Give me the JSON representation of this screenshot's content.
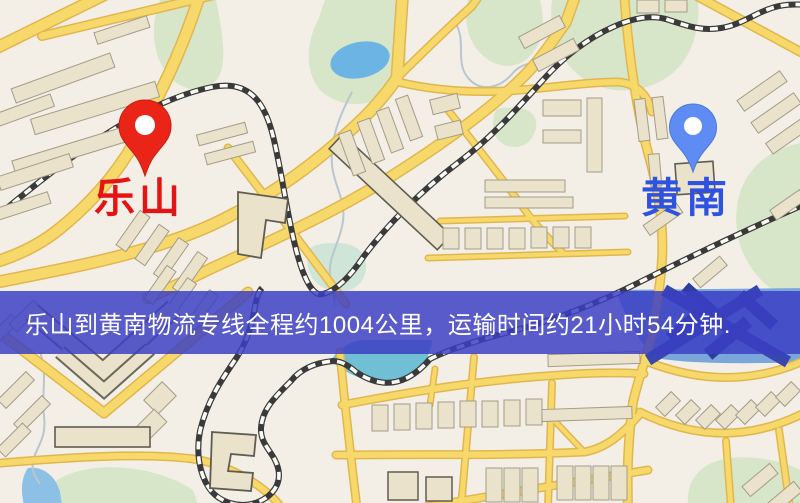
{
  "map": {
    "markers": {
      "origin": {
        "name": "乐山",
        "pin_color": "#ea2417",
        "label_color": "#e51313"
      },
      "destination": {
        "name": "黄南",
        "pin_color": "#5e8cf2",
        "label_color": "#2f52e0"
      }
    },
    "banner": {
      "text": "乐山到黄南物流专线全程约1004公里，运输时间约21小时54分钟.",
      "background": "#3a3ec4",
      "text_color": "#ffffff"
    },
    "palette": {
      "map_background": "#f3efe7",
      "road_fill": "#f7d96b",
      "road_casing": "#e2b64e",
      "building_fill": "#eae2cb",
      "park_green": "#d7e6c8",
      "water_blue": "#6cb4e4",
      "railway_dark": "#3a3a3a"
    }
  }
}
